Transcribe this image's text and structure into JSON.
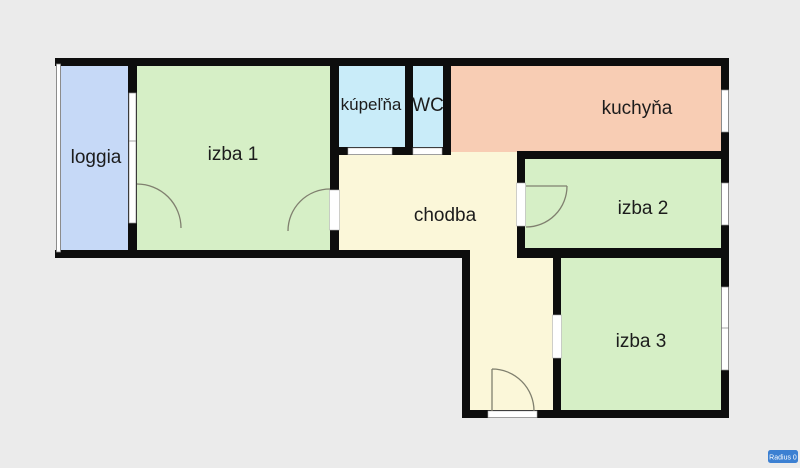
{
  "colors": {
    "background": "#ebebeb",
    "wall": "#0d0d0d",
    "room_green": "#d6efc6",
    "loggia_blue": "#c6d9f7",
    "bath_cyan": "#c9ecf9",
    "kitchen_salmon": "#f8cdb4",
    "hall_cream": "#fbf7d9",
    "window_white": "#ffffff",
    "door_arc": "#80806f",
    "label_text": "#1c1c1c",
    "badge_bg": "#3c80d2",
    "badge_text": "#ffffff"
  },
  "rooms": {
    "loggia": {
      "label": "loggia"
    },
    "izba1": {
      "label": "izba 1"
    },
    "kupelna": {
      "label": "kúpeľňa"
    },
    "wc": {
      "label": "WC"
    },
    "kuchyna": {
      "label": "kuchyňa"
    },
    "chodba": {
      "label": "chodba"
    },
    "izba2": {
      "label": "izba 2"
    },
    "izba3": {
      "label": "izba 3"
    }
  },
  "badge": {
    "label": "Radius 0"
  }
}
